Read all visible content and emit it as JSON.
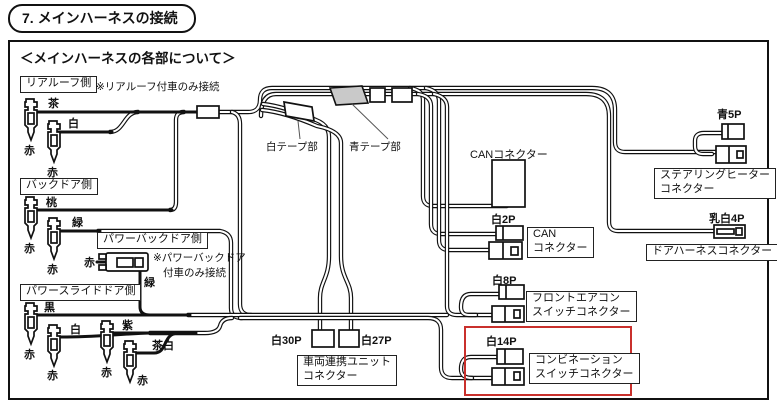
{
  "title": "7. メインハーネスの接続",
  "section_heading": "＜メインハーネスの各部について＞",
  "colors": {
    "highlight": "#c9302c",
    "blue_tape_fill": "#c9c9c9",
    "line": "#111111"
  },
  "groups": {
    "rear_roof": {
      "label": "リアルーフ側",
      "note": "※リアルーフ付車のみ接続",
      "wire1": "茶",
      "wire2": "白",
      "term1": "赤",
      "term2": "赤"
    },
    "back_door": {
      "label": "バックドア側",
      "wire1": "桃",
      "wire2": "緑",
      "term1": "赤",
      "term2": "赤"
    },
    "power_back_door": {
      "label": "パワーバックドア側",
      "note1": "※パワーバックドア",
      "note2": "付車のみ接続",
      "wire1": "赤",
      "wire2": "緑"
    },
    "power_slide_door": {
      "label": "パワースライドドア側",
      "wire1": "黒",
      "wire2": "白",
      "wire3": "紫",
      "wire4": "茶白",
      "term1": "赤",
      "term2": "赤",
      "term3": "赤",
      "term4": "赤"
    }
  },
  "tapes": {
    "white": "白テープ部",
    "blue": "青テープ部"
  },
  "connectors": {
    "can_main": {
      "label": "CANコネクター"
    },
    "can_sub": {
      "pin": "白2P",
      "label1": "CAN",
      "label2": "コネクター"
    },
    "steering_heater": {
      "pin": "青5P",
      "label1": "ステアリングヒーター",
      "label2": "コネクター"
    },
    "door_harness": {
      "pin": "乳白4P",
      "label": "ドアハーネスコネクター"
    },
    "front_aircon": {
      "pin": "白8P",
      "label1": "フロントエアコン",
      "label2": "スイッチコネクター"
    },
    "combination": {
      "pin": "白14P",
      "label1": "コンビネーション",
      "label2": "スイッチコネクター"
    },
    "vehicle_link": {
      "pin_left": "白30P",
      "pin_right": "白27P",
      "label1": "車両連携ユニット",
      "label2": "コネクター"
    }
  }
}
